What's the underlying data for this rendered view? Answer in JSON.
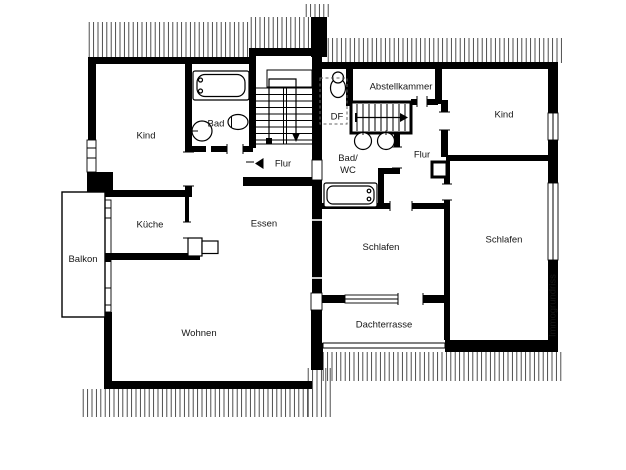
{
  "floor_plan": {
    "background_color": "#ffffff",
    "wall_color": "#000000",
    "hatch_color": "#3c3c3c",
    "left_unit": {
      "rooms": {
        "kind": "Kind",
        "bad": "Bad",
        "flur": "Flur",
        "kueche": "Küche",
        "essen": "Essen",
        "balkon": "Balkon",
        "wohnen": "Wohnen"
      }
    },
    "right_unit": {
      "rooms": {
        "abstellkammer": "Abstellkammer",
        "df": "DF",
        "bad_wc_line1": "Bad/",
        "bad_wc_line2": "WC",
        "flur": "Flur",
        "kind": "Kind",
        "schlafen_1": "Schlafen",
        "schlafen_2": "Schlafen",
        "dachterrasse": "Dachterrasse"
      }
    },
    "watermark": "Immogrundriss"
  }
}
